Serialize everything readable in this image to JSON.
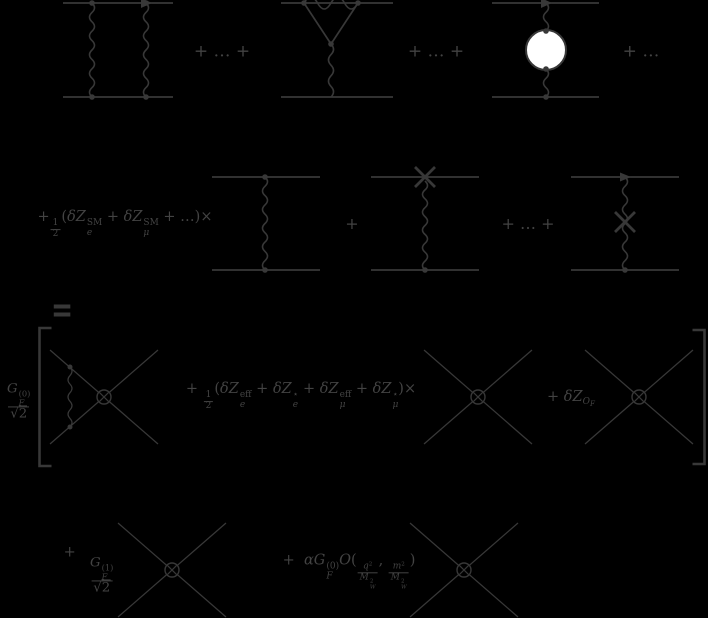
{
  "colors": {
    "background": "#000000",
    "ink": "#383838",
    "text": "#434343",
    "blob_fill": "#ffffff"
  },
  "figure": {
    "row1": {
      "plus_after_box": "+ … +",
      "plus_after_vertex": "+ … +",
      "plus_trailing": "+ …"
    },
    "row2": {
      "prefactor": [
        {
          "t": "txt",
          "v": "+"
        },
        {
          "t": "frac",
          "small": true,
          "num": [
            {
              "t": "txt",
              "v": "1"
            }
          ],
          "den": [
            {
              "t": "txt",
              "v": "2"
            }
          ]
        },
        {
          "t": "txt",
          "v": "("
        },
        {
          "t": "it",
          "v": "δZ"
        },
        {
          "t": "ss",
          "sub": "e",
          "sup": "SM"
        },
        {
          "t": "txt",
          "v": " + "
        },
        {
          "t": "it",
          "v": "δZ"
        },
        {
          "t": "ss",
          "sub": "μ",
          "sup": "SM"
        },
        {
          "t": "txt",
          "v": " + …)×"
        }
      ],
      "plus": "+",
      "plus_dots": "+ … +"
    },
    "row3": {
      "equals": "=",
      "gf0": [
        {
          "t": "frac",
          "num": [
            {
              "t": "it",
              "v": "G"
            },
            {
              "t": "ss",
              "sub": "F",
              "sup": "(0)"
            }
          ],
          "den": [
            {
              "t": "sqrt",
              "v": "2"
            }
          ]
        }
      ],
      "wavefunction_term": [
        {
          "t": "txt",
          "v": "+ "
        },
        {
          "t": "frac",
          "small": true,
          "num": [
            {
              "t": "txt",
              "v": "1"
            }
          ],
          "den": [
            {
              "t": "txt",
              "v": "2"
            }
          ]
        },
        {
          "t": "txt",
          "v": "("
        },
        {
          "t": "it",
          "v": "δZ"
        },
        {
          "t": "ss",
          "sub": "e",
          "sup": "eff"
        },
        {
          "t": "txt",
          "v": " + "
        },
        {
          "t": "it",
          "v": "δZ"
        },
        {
          "t": "ss",
          "sub": "e",
          "sup": "⋆"
        },
        {
          "t": "txt",
          "v": " + "
        },
        {
          "t": "it",
          "v": "δZ"
        },
        {
          "t": "ss",
          "sub": "μ",
          "sup": "eff"
        },
        {
          "t": "txt",
          "v": " + "
        },
        {
          "t": "it",
          "v": "δZ"
        },
        {
          "t": "ss",
          "sub": "μ",
          "sup": "⋆"
        },
        {
          "t": "txt",
          "v": ")×"
        }
      ],
      "operator_ct_term": [
        {
          "t": "txt",
          "v": "+ "
        },
        {
          "t": "it",
          "v": "δZ"
        },
        {
          "t": "sub",
          "tk": [
            {
              "t": "it",
              "v": "O"
            },
            {
              "t": "sub",
              "v": "F"
            }
          ]
        }
      ]
    },
    "row4": {
      "gf1_term": [
        {
          "t": "txt",
          "v": "+  "
        },
        {
          "t": "frac",
          "num": [
            {
              "t": "it",
              "v": "G"
            },
            {
              "t": "ss",
              "sub": "F",
              "sup": "(1)"
            }
          ],
          "den": [
            {
              "t": "sqrt",
              "v": "2"
            }
          ]
        }
      ],
      "alpha_term": [
        {
          "t": "txt",
          "v": "+  "
        },
        {
          "t": "it",
          "v": "α"
        },
        {
          "t": "it",
          "v": "G"
        },
        {
          "t": "ss",
          "sub": "F",
          "sup": "(0)"
        },
        {
          "t": "cal",
          "v": "O"
        },
        {
          "t": "txt",
          "v": "("
        },
        {
          "t": "frac",
          "small": true,
          "num": [
            {
              "t": "it",
              "v": "q"
            },
            {
              "t": "sup",
              "v": "2"
            }
          ],
          "den": [
            {
              "t": "it",
              "v": "M"
            },
            {
              "t": "ss",
              "sub": "W",
              "sup": "2"
            }
          ]
        },
        {
          "t": "txt",
          "v": ", "
        },
        {
          "t": "frac",
          "small": true,
          "num": [
            {
              "t": "it",
              "v": "m"
            },
            {
              "t": "sup",
              "v": "2"
            }
          ],
          "den": [
            {
              "t": "it",
              "v": "M"
            },
            {
              "t": "ss",
              "sub": "W",
              "sup": "2"
            }
          ]
        },
        {
          "t": "txt",
          "v": ")"
        }
      ]
    }
  }
}
